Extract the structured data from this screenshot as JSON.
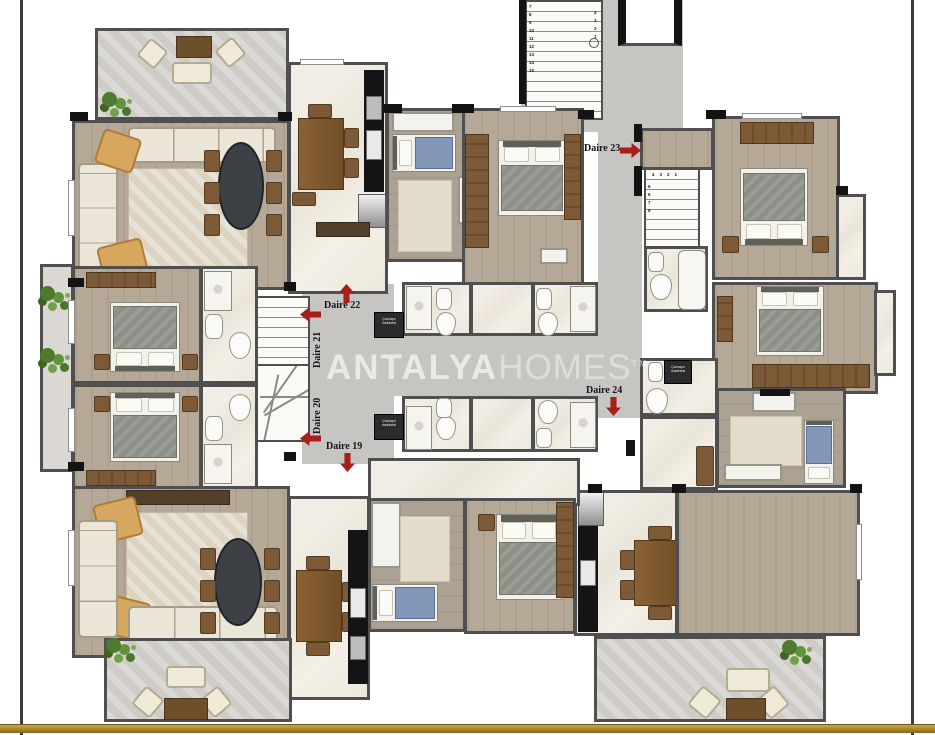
{
  "watermark": {
    "bold": "ANTALYA",
    "light": "HOMES",
    "tm": "TM"
  },
  "units": [
    {
      "label": "Daire 19",
      "arrow": "down"
    },
    {
      "label": "Daire 20",
      "arrow": "left"
    },
    {
      "label": "Daire 21",
      "arrow": "left"
    },
    {
      "label": "Daire 22",
      "arrow": "up"
    },
    {
      "label": "Daire 23",
      "arrow": "right"
    },
    {
      "label": "Daire 24",
      "arrow": "down"
    }
  ],
  "appliances": {
    "washer": "Çamaşır makinesi"
  },
  "stairs": {
    "main": {
      "left": [
        "7",
        "8",
        "9",
        "10",
        "11",
        "12",
        "13",
        "14",
        "15"
      ],
      "right": [
        "4",
        "3",
        "2",
        "1"
      ],
      "bottom": [
        "16",
        "17"
      ]
    },
    "duplex": {
      "top": [
        "4",
        "3",
        "2",
        "1"
      ],
      "left": [
        "5",
        "6",
        "7",
        "8"
      ]
    }
  },
  "colors": {
    "arrow": "#a81f17",
    "wall": "#4f4f4f",
    "wood_floor": "#b5a896",
    "marble_floor": "#f0ece2",
    "balcony_tile": "#cfccc7",
    "corridor": "#c7c5c2",
    "gold_bar": "#a8842f",
    "watermark": "#e8e8e8"
  }
}
